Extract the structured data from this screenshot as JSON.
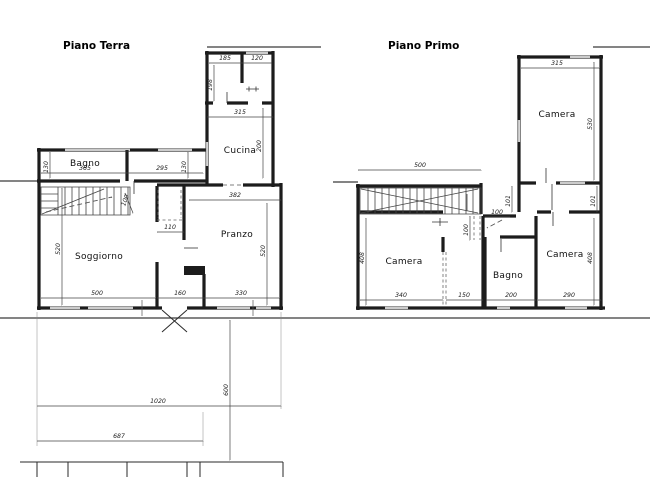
{
  "drawing": {
    "background": "#ffffff",
    "wall_color": "#1c1c1c",
    "dim_color": "#444444",
    "floors": {
      "terra": {
        "title": "Piano Terra",
        "rooms": {
          "bagno": "Bagno",
          "cucina": "Cucina",
          "soggiorno": "Soggiorno",
          "pranzo": "Pranzo"
        },
        "dims": {
          "d185": "185",
          "d120": "120",
          "d198": "198",
          "d315": "315",
          "d200": "200",
          "d130a": "130",
          "d365": "365",
          "d295": "295",
          "d130b": "130",
          "d382": "382",
          "d100": "100",
          "d110": "110",
          "d520a": "520",
          "d500": "500",
          "d160": "160",
          "d330": "330",
          "d520b": "520",
          "d1020": "1020",
          "d600": "600",
          "d687": "687"
        }
      },
      "primo": {
        "title": "Piano Primo",
        "rooms": {
          "camera_top": "Camera",
          "camera_left": "Camera",
          "bagno": "Bagno",
          "camera_right": "Camera"
        },
        "dims": {
          "d315": "315",
          "d530": "530",
          "d500": "500",
          "d101a": "101",
          "d101b": "101",
          "d100a": "100",
          "d100b": "100",
          "d408a": "408",
          "d340": "340",
          "d150": "150",
          "d200": "200",
          "d290": "290",
          "d408b": "408"
        }
      }
    }
  }
}
